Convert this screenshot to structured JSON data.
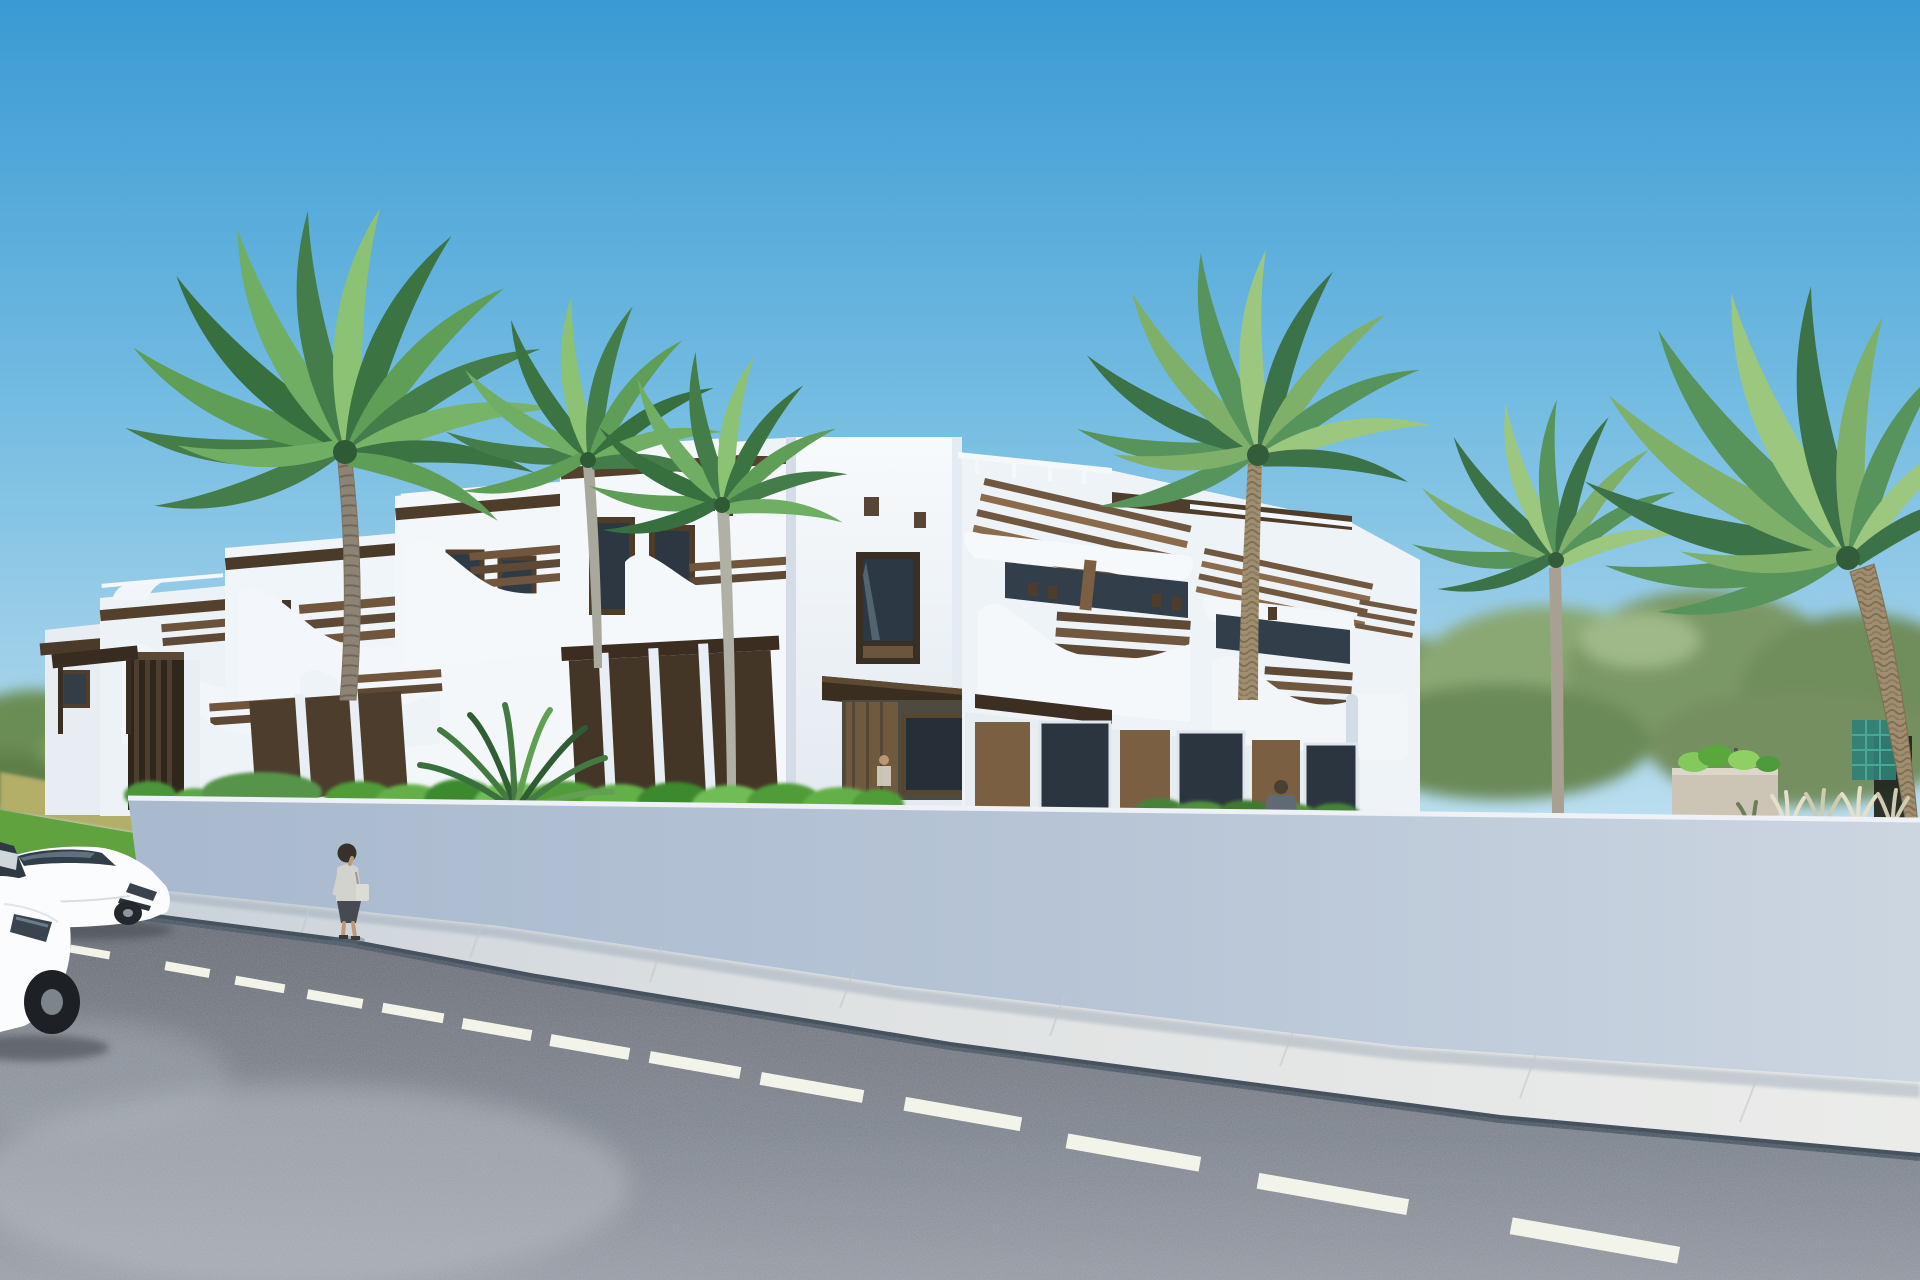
{
  "scene": {
    "type": "3D architectural exterior rendering",
    "description": "Photorealistic CGI street view of a modern white Mediterranean-style apartment complex with dark wood pergolas and wavy balcony parapets, fronted by a white perimeter wall, green hedges and tall palm trees. An asphalt road with dashed lane markings runs along the foreground with two white sedans on the left and a woman walking on the sidewalk.",
    "time_of_day": "midday, clear sunny sky",
    "weather": "clear"
  },
  "buildings": {
    "left_wing": "two-storey white townhouses receding to the left with stepped parapets and wavy balcony walls",
    "center_tower": "tall white stair tower with small vent openings and a tall dark-framed window above the entrance canopy",
    "right_wing": "two-storey apartments with wood pergola sunshades, wavy balconies and wood-clad ground floor",
    "features": [
      "stepped white parapets",
      "curved wavy balcony walls",
      "dark wood pergolas and slat railings",
      "wood-clad ground floors",
      "brown framed glazing",
      "small square vent openings"
    ]
  },
  "street": {
    "elements": [
      "white perimeter wall",
      "paved sidewalk",
      "grey asphalt road",
      "dashed white center line",
      "entrance gate with wooden slats",
      "green lawn strip at far left"
    ]
  },
  "vegetation": {
    "palms": [
      "large palm left of center",
      "pair of slim palms at center",
      "date palm cluster on the right",
      "twin date palms at far right"
    ],
    "other": [
      "bright green hedge behind the wall",
      "cycad fern bush",
      "low shrubs on the right",
      "stone planter with plants",
      "white ornamental grasses",
      "blurred distant trees"
    ]
  },
  "vehicles": [
    {
      "label": "white sedan, foreground, partially cropped at left edge"
    },
    {
      "label": "white sedan parked along the street behind it"
    }
  ],
  "people": [
    {
      "label": "woman walking on the sidewalk carrying a light bag"
    },
    {
      "label": "man visible behind the perimeter wall on the right"
    },
    {
      "label": "small figure at a ground-floor window of the tower"
    }
  ],
  "colors": {
    "sky_top": "#3a9ad3",
    "sky_mid": "#74bce2",
    "sky_horizon": "#c9e6f3",
    "white_sunlit": "#f7fafc",
    "white_shadow": "#dbe3ec",
    "wood_dark": "#46382a",
    "wood_light": "#8a6c4c",
    "glass": "#323f4b",
    "palm_green": "#447d49",
    "palm_green_light": "#8cc274",
    "hedge_green": "#55a23c",
    "trunk_brown": "#a08e70",
    "wall_shadow": "#a9b9ce",
    "wall_light": "#ccd6e1",
    "sidewalk": "#ebecea",
    "road_dark": "#62666f",
    "road_light": "#979ca6",
    "lane_marking": "#f2f3e9",
    "car_white": "#fbfcfd",
    "curb_shadow": "#46535f"
  }
}
